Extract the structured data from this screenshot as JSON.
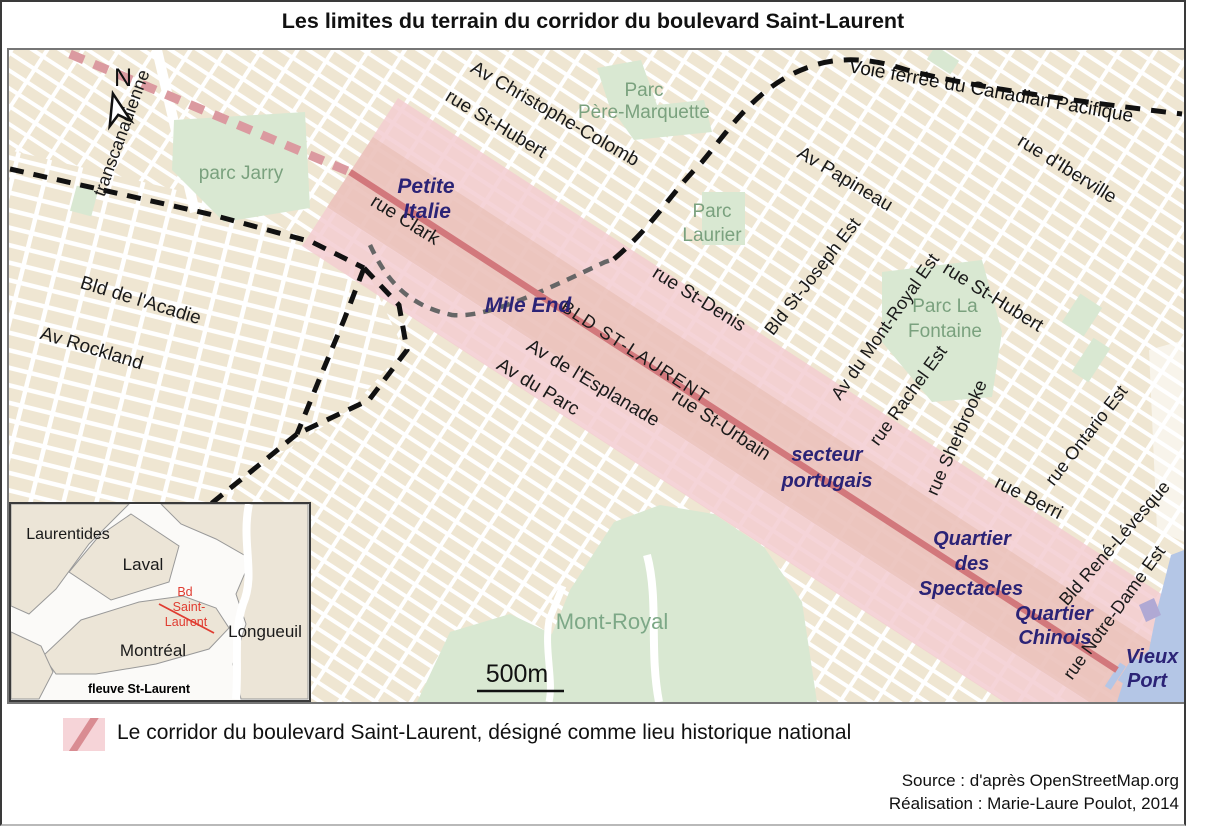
{
  "title": "Les limites du terrain du corridor du boulevard Saint-Laurent",
  "compass": {
    "north": "N"
  },
  "map": {
    "streets": {
      "transcanadienne": "transcanadienne",
      "bld_acadie": "Bld de l'Acadie",
      "av_rockland": "Av Rockland",
      "rue_clark": "rue Clark",
      "av_christophe_colomb": "Av Christophe-Colomb",
      "rue_st_hubert_nord": "rue St-Hubert",
      "rue_st_denis": "rue St-Denis",
      "av_papineau": "Av Papineau",
      "rue_iberville": "rue d'Iberville",
      "bld_st_joseph": "Bld St-Joseph Est",
      "av_mont_royal": "Av du Mont-Royal Est",
      "rue_st_hubert_est": "rue St-Hubert",
      "rue_rachel": "rue Rachel Est",
      "rue_sherbrooke": "rue Sherbrooke",
      "rue_berri": "rue Berri",
      "rue_ontario": "rue Ontario Est",
      "bld_rene_levesque": "Bld René-Lévesque",
      "rue_notre_dame": "rue Notre-Dame Est",
      "bld_st_laurent": "BLD ST-LAURENT",
      "rue_st_urbain": "rue St-Urbain",
      "av_esplanade": "Av de l'Esplanade",
      "av_du_parc": "Av du Parc"
    },
    "railway_label": "Voie ferrée du Canadian Pacifique",
    "districts": {
      "petite_italie": [
        "Petite",
        "Italie"
      ],
      "mile_end": "Mile End",
      "secteur_portugais": [
        "secteur",
        "portugais"
      ],
      "quartier_spectacles": [
        "Quartier",
        "des",
        "Spectacles"
      ],
      "quartier_chinois": [
        "Quartier",
        "Chinois"
      ],
      "vieux_port": [
        "Vieux",
        "Port"
      ]
    },
    "parks": {
      "jarry": "parc Jarry",
      "pere_marquette": [
        "Parc",
        "Père-Marquette"
      ],
      "laurier": [
        "Parc",
        "Laurier"
      ],
      "la_fontaine": [
        "Parc La",
        "Fontaine"
      ],
      "mont_royal": "Mont-Royal"
    },
    "scale_label": "500m"
  },
  "inset": {
    "labels": {
      "laurentides": "Laurentides",
      "laval": "Laval",
      "montreal": "Montréal",
      "longueuil": "Longueuil",
      "fleuve": "fleuve St-Laurent",
      "bd_saint_laurent": [
        "Bd",
        "Saint-",
        "Laurent"
      ]
    }
  },
  "legend": {
    "text": "Le corridor du boulevard Saint-Laurent, désigné comme lieu historique national"
  },
  "credits": {
    "source": "Source : d'après OpenStreetMap.org",
    "realisation": "Réalisation : Marie-Laure Poulot, 2014"
  },
  "colors": {
    "corridor_fill": "#f3ccd1",
    "corridor_core": "#e5bcae",
    "boulevard_red": "#d2787c",
    "corridor_dashed_pink": "#db9aa0",
    "boundary_dashed_black": "#111111",
    "boundary_dashed_gray": "#666666",
    "district_navy": "#2b2376",
    "park_green": "#d9e8d2",
    "park_text_green": "#7aa17e",
    "water_blue": "#b4c6e6",
    "block_beige": "#efe6d2"
  }
}
